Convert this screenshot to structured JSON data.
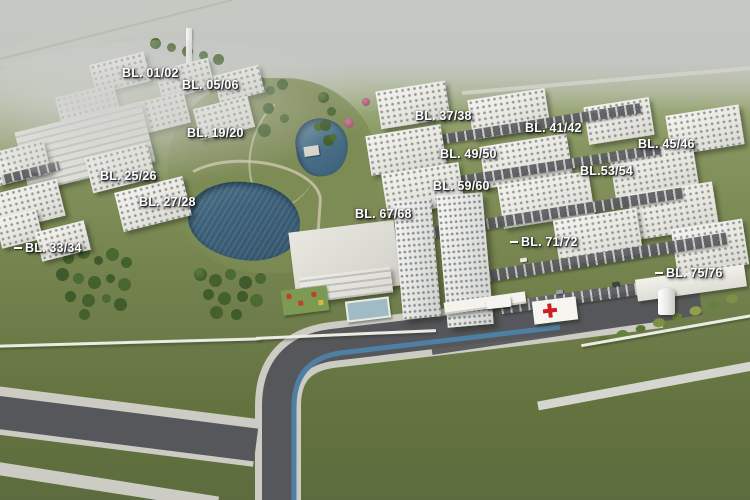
{
  "scene": {
    "description": "Aerial 3D architectural rendering of a residential condominium master plan with labeled apartment blocks, two lakes, a park, clubhouse, entrance gate with first-aid post, and perimeter roads",
    "colors": {
      "haze_sky": "#c6c8c4",
      "field_green": "#7b8a54",
      "lawn_dark_green": "#5d6c3e",
      "park_green": "#7d8b55",
      "road_asphalt": "#56575b",
      "sidewalk": "#cbccc5",
      "bike_lane_blue": "#4e80a5",
      "lake_blue": "#40647e",
      "building_white": "#f1f0e9",
      "building_tan_accent": "#c4a269",
      "tree_green": "#44602d",
      "flowering_pink": "#a4556e",
      "flowering_orange": "#b0702f",
      "label_text": "#ffffff",
      "red_cross": "#cf1d1d"
    }
  },
  "labels": [
    {
      "id": "bl-01-02",
      "text": "BL. 01/02",
      "x": 122,
      "y": 66
    },
    {
      "id": "bl-05-06",
      "text": "BL. 05/06",
      "x": 182,
      "y": 78
    },
    {
      "id": "bl-19-20",
      "text": "BL. 19/20",
      "x": 187,
      "y": 126
    },
    {
      "id": "bl-25-26",
      "text": "BL. 25/26",
      "x": 100,
      "y": 169
    },
    {
      "id": "bl-27-28",
      "text": "BL. 27/28",
      "x": 139,
      "y": 195
    },
    {
      "id": "bl-33-34",
      "text": "BL. 33/34",
      "x": 14,
      "y": 241,
      "leader": true
    },
    {
      "id": "bl-37-38",
      "text": "BL. 37/38",
      "x": 415,
      "y": 109
    },
    {
      "id": "bl-41-42",
      "text": "BL. 41/42",
      "x": 525,
      "y": 121
    },
    {
      "id": "bl-45-46",
      "text": "BL. 45/46",
      "x": 638,
      "y": 137
    },
    {
      "id": "bl-49-50",
      "text": "BL. 49/50",
      "x": 440,
      "y": 147
    },
    {
      "id": "bl-53-54",
      "text": "BL.53/54",
      "x": 580,
      "y": 164
    },
    {
      "id": "bl-59-60",
      "text": "BL. 59/60",
      "x": 433,
      "y": 179
    },
    {
      "id": "bl-67-68",
      "text": "BL. 67/68",
      "x": 355,
      "y": 207
    },
    {
      "id": "bl-71-72",
      "text": "BL. 71/72",
      "x": 510,
      "y": 235,
      "leader": true
    },
    {
      "id": "bl-75-76",
      "text": "BL. 75/76",
      "x": 655,
      "y": 266,
      "leader": true
    }
  ]
}
